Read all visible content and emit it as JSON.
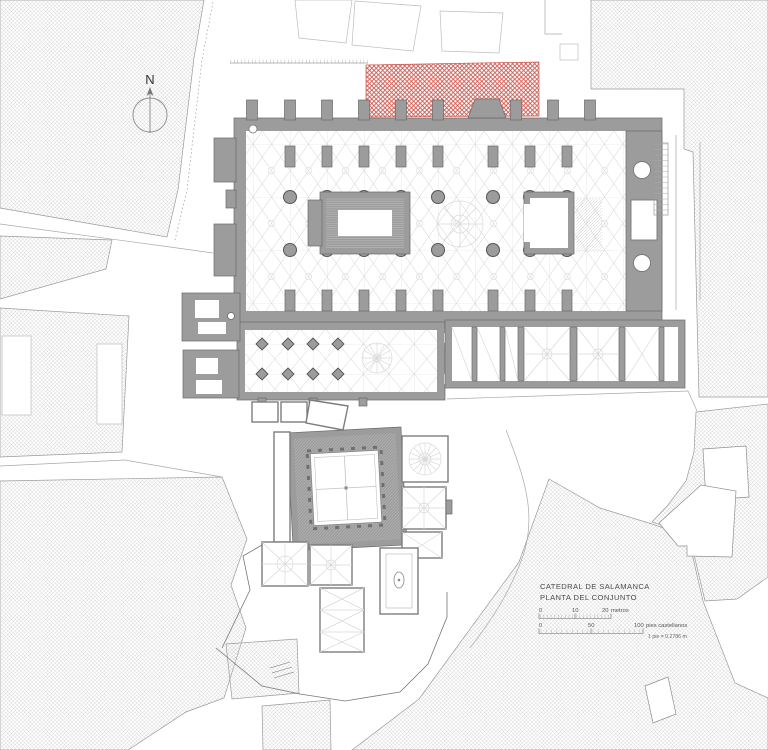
{
  "plan": {
    "north_label": "N",
    "title": {
      "line1": "CATEDRAL DE SALAMANCA",
      "line2": "PLANTA DEL CONJUNTO"
    },
    "scales": {
      "metric": {
        "t0": "0",
        "t1": "10",
        "t2": "20",
        "unit": "metros"
      },
      "castilian": {
        "t0": "0",
        "t1": "50",
        "t2": "100",
        "unit": "pies castellanos",
        "note": "1 pie = 0.2786 m"
      }
    },
    "colors": {
      "wall": "#9c9c9c",
      "wall_dark": "#6a6a6a",
      "hatch": "#cdcdcd",
      "red": "#c9493f",
      "vault": "#d9d9d9"
    }
  }
}
